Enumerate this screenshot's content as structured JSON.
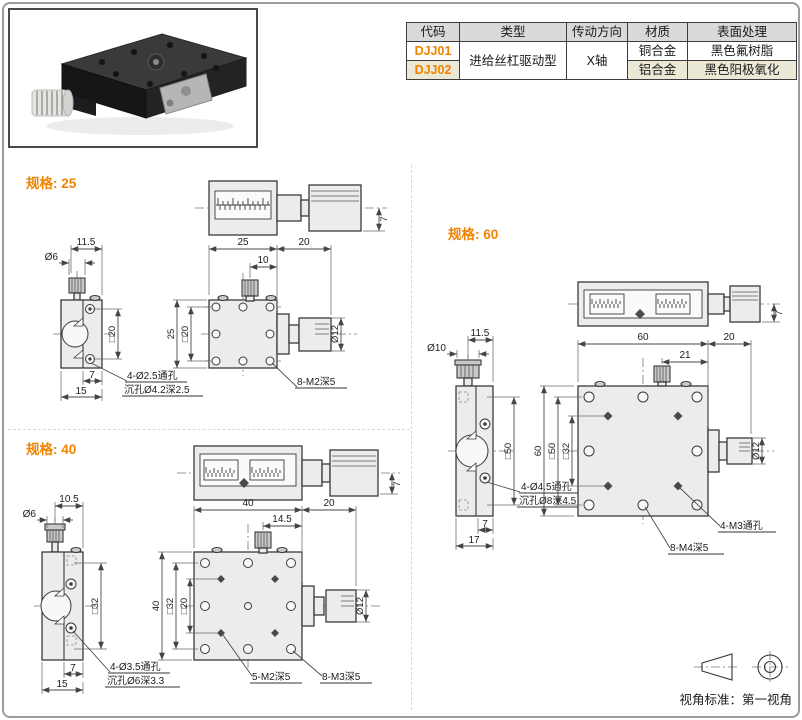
{
  "page": {
    "accent": "#f08300",
    "border_color": "#9b9b9b"
  },
  "table": {
    "headers": [
      "代码",
      "类型",
      "传动方向",
      "材质",
      "表面处理"
    ],
    "type_value": "进给丝杠驱动型",
    "direction_value": "X轴",
    "rows": [
      {
        "code": "DJJ01",
        "material": "铜合金",
        "finish": "黑色氟树脂"
      },
      {
        "code": "DJJ02",
        "material": "铝合金",
        "finish": "黑色阳极氧化"
      }
    ]
  },
  "specs": {
    "s25": {
      "title": "规格: 25",
      "plan": {
        "h": "7"
      },
      "side": {
        "top": "11.5",
        "dia": "Ø6",
        "sq": "□20",
        "off": "7",
        "w": "15",
        "note1": "4-Ø2.5通孔",
        "note2": "沉孔Ø4.2深2.5"
      },
      "front": {
        "w": "25",
        "len": "20",
        "off": "10",
        "h": "25",
        "sq1": "□20",
        "dia": "Ø12",
        "note1": "8-M2深5"
      }
    },
    "s40": {
      "title": "规格: 40",
      "plan": {
        "h": "7"
      },
      "side": {
        "top": "10.5",
        "dia": "Ø6",
        "sq": "□32",
        "off": "7",
        "w": "15",
        "note1": "4-Ø3.5通孔",
        "note2": "沉孔Ø6深3.3"
      },
      "front": {
        "w": "40",
        "len": "20",
        "off": "14.5",
        "h": "40",
        "sq1": "□32",
        "sq2": "□20",
        "dia": "Ø12",
        "note1": "5-M2深5",
        "note2": "8-M3深5"
      }
    },
    "s60": {
      "title": "规格: 60",
      "plan": {
        "h": "7"
      },
      "side": {
        "top": "11.5",
        "dia": "Ø10",
        "sq": "□50",
        "off": "7",
        "w": "17",
        "note1": "4-Ø4.5通孔",
        "note2": "沉孔Ø8深4.5"
      },
      "front": {
        "w": "60",
        "len": "20",
        "off": "21",
        "h": "60",
        "sq1": "□50",
        "sq2": "□32",
        "dia": "Ø12",
        "note1": "4-M3通孔",
        "note2": "8-M4深5"
      }
    }
  },
  "footer": {
    "view_standard": "视角标准：第一视角"
  }
}
